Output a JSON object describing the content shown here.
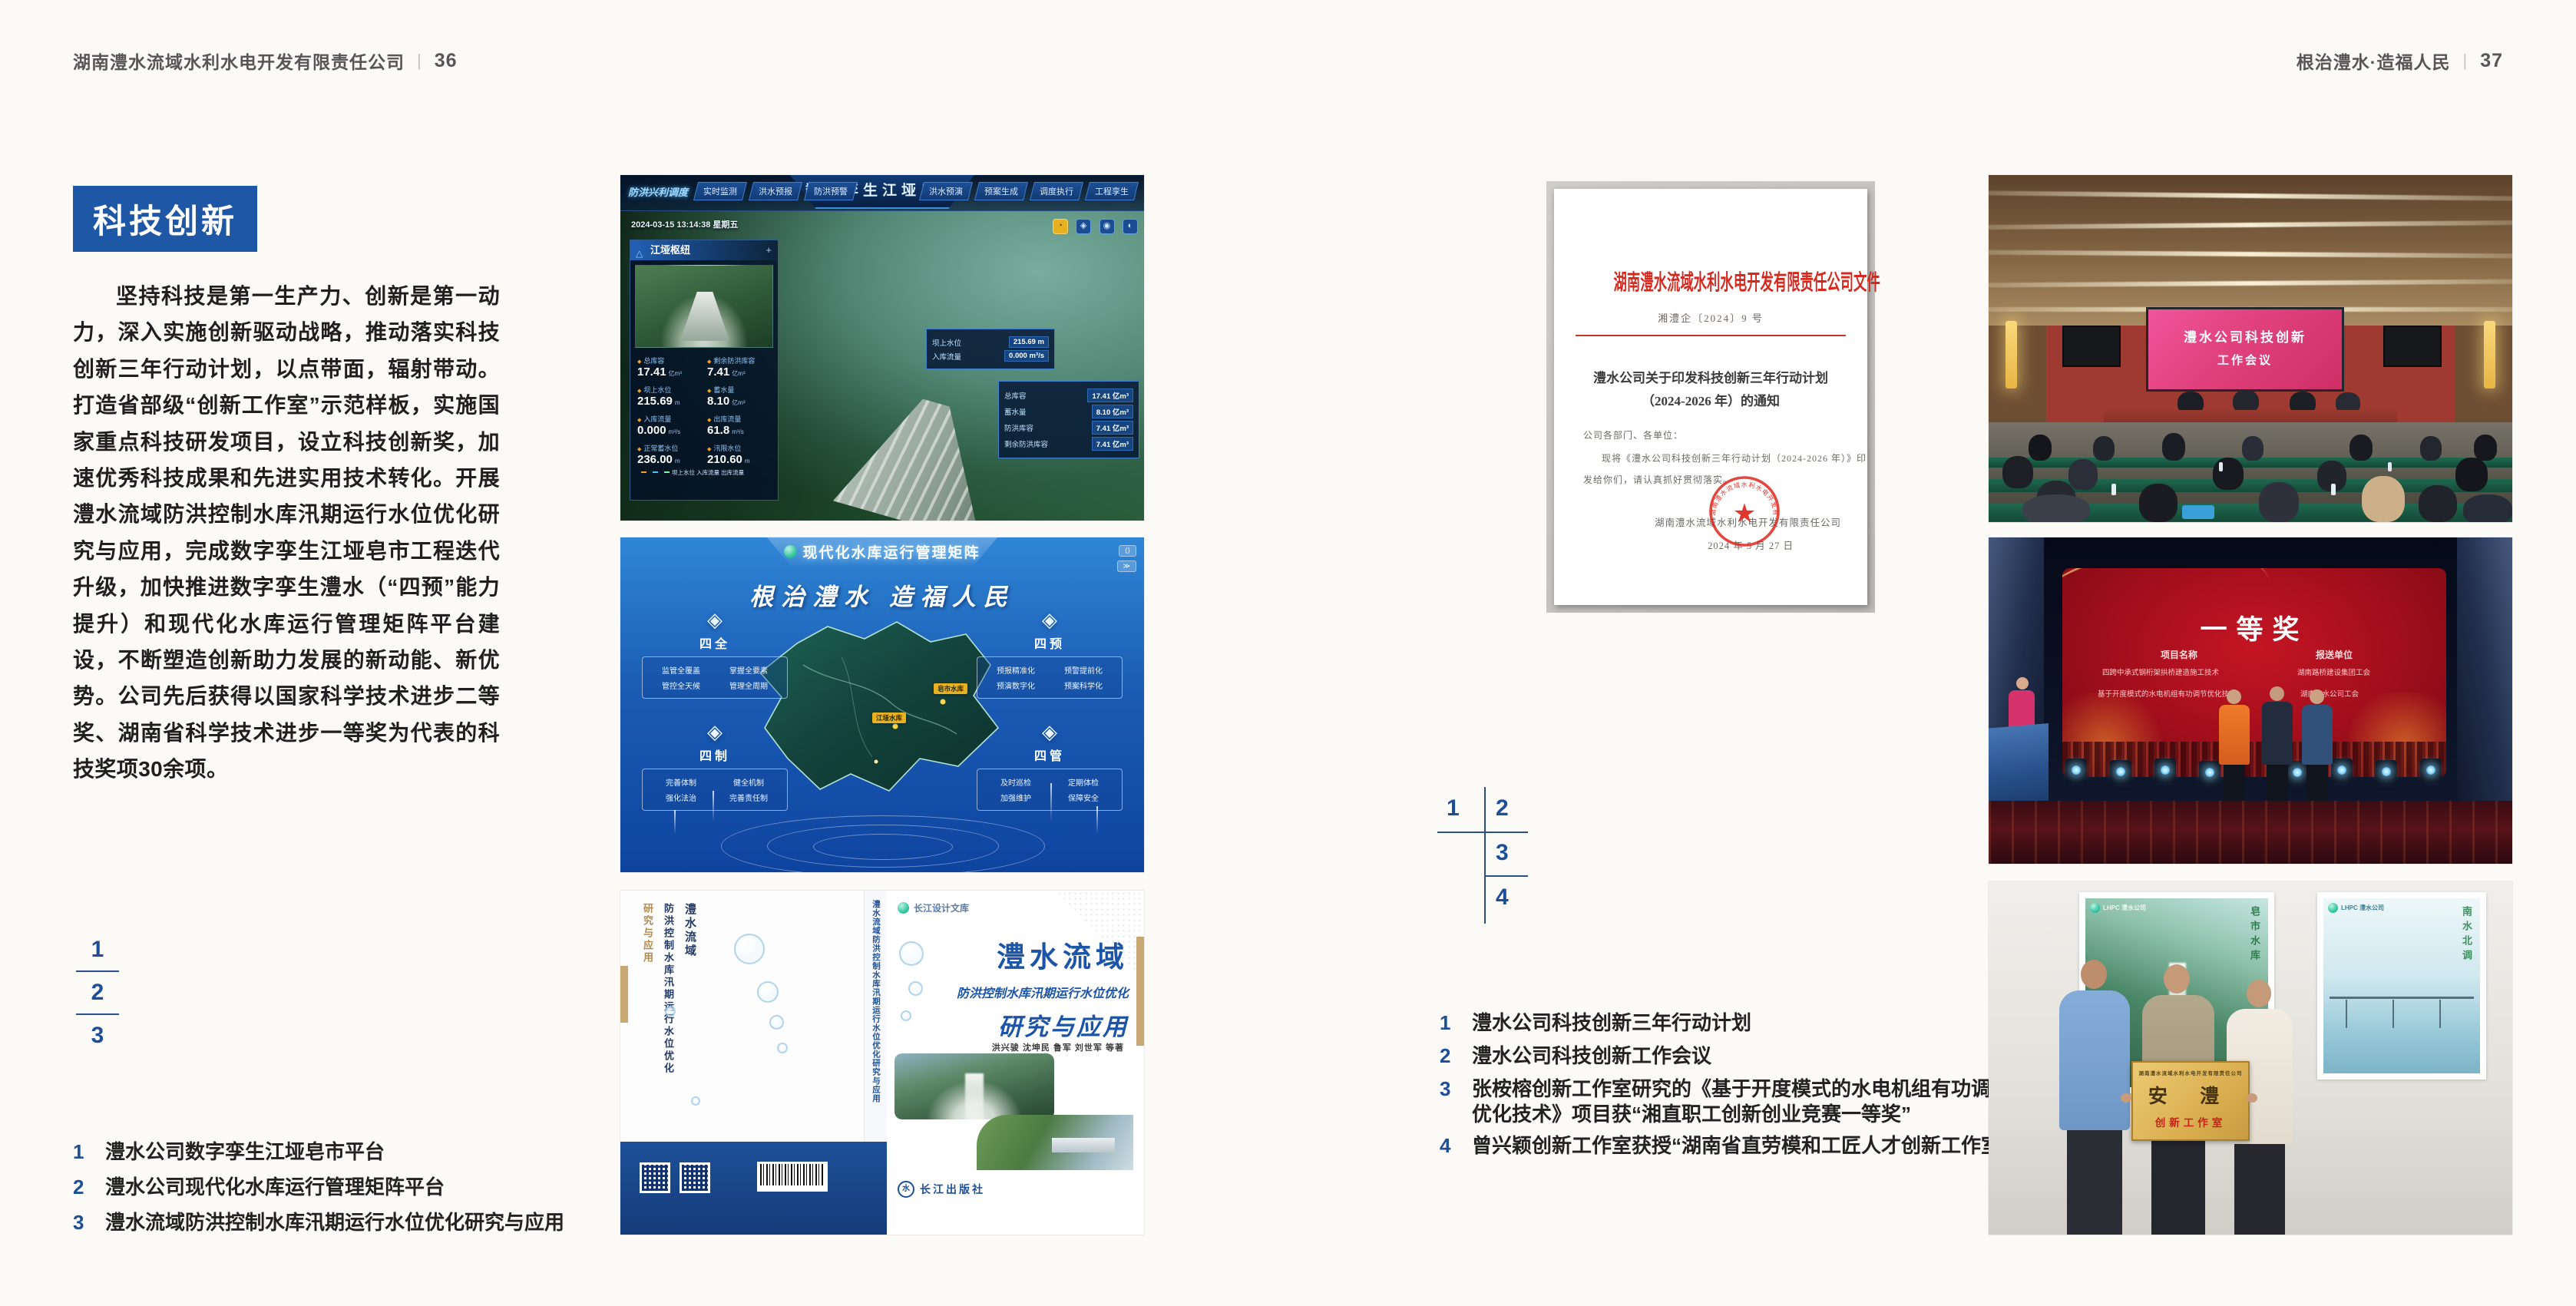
{
  "colors": {
    "accent_blue": "#1e57a5",
    "index_blue": "#1e4e96",
    "doc_red": "#d5281e"
  },
  "page_left": {
    "header": {
      "company": "湖南澧水流域水利水电开发有限责任公司",
      "divider": "|",
      "page_no": "36"
    },
    "section_title": "科技创新",
    "body_text": "坚持科技是第一生产力、创新是第一动力，深入实施创新驱动战略，推动落实科技创新三年行动计划，以点带面，辐射带动。打造省部级“创新工作室”示范样板，实施国家重点科技研发项目，设立科技创新奖，加速优秀科技成果和先进实用技术转化。开展澧水流域防洪控制水库汛期运行水位优化研究与应用，完成数字孪生江垭皂市工程迭代升级，加快推进数字孪生澧水（“四预”能力提升）和现代化水库运行管理矩阵平台建设，不断塑造创新助力发展的新动能、新优势。公司先后获得以国家科学技术进步二等奖、湖南省科学技术进步一等奖为代表的科技奖项30余项。",
    "figure_index": [
      "1",
      "2",
      "3"
    ],
    "captions": [
      {
        "no": "1",
        "text": "澧水公司数字孪生江垭皂市平台"
      },
      {
        "no": "2",
        "text": "澧水公司现代化水库运行管理矩阵平台"
      },
      {
        "no": "3",
        "text": "澧水流域防洪控制水库汛期运行水位优化研究与应用"
      }
    ]
  },
  "page_right": {
    "header": {
      "slogan": "根治澧水·造福人民",
      "divider": "|",
      "page_no": "37"
    },
    "figure_index": [
      "1",
      "2",
      "3",
      "4"
    ],
    "captions": [
      {
        "no": "1",
        "line1": "澧水公司科技创新三年行动计划"
      },
      {
        "no": "2",
        "line1": "澧水公司科技创新工作会议"
      },
      {
        "no": "3",
        "line1": "张桉榕创新工作室研究的《基于开度模式的水电机组有功调节",
        "line2": "优化技术》项目获“湘直职工创新创业竞赛一等奖”"
      },
      {
        "no": "4",
        "line1": "曾兴颖创新工作室获授“湖南省直劳模和工匠人才创新工作室”"
      }
    ]
  },
  "fig_twin": {
    "title": "数字孪生江垭皂市",
    "nav_group": "防洪兴利调度",
    "tabs_left": [
      "实时监测",
      "洪水预报",
      "防洪预警"
    ],
    "tabs_right": [
      "洪水预演",
      "预案生成",
      "调度执行",
      "工程孪生"
    ],
    "timestamp": "2024-03-15 13:14:38 星期五",
    "panel_title": "江垭枢纽",
    "stats": [
      {
        "label": "总库容",
        "value": "17.41",
        "unit": "亿m³"
      },
      {
        "label": "剩余防洪库容",
        "value": "7.41",
        "unit": "亿m³"
      },
      {
        "label": "坝上水位",
        "value": "215.69",
        "unit": "m"
      },
      {
        "label": "蓄水量",
        "value": "8.10",
        "unit": "亿m³"
      },
      {
        "label": "入库流量",
        "value": "0.000",
        "unit": "m³/s"
      },
      {
        "label": "出库流量",
        "value": "61.8",
        "unit": "m³/s"
      },
      {
        "label": "正常蓄水位",
        "value": "236.00",
        "unit": "m"
      },
      {
        "label": "汛限水位",
        "value": "210.60",
        "unit": "m"
      }
    ],
    "legend": "坝上水位 入库流量 出库流量",
    "tip1": [
      {
        "label": "坝上水位",
        "value": "215.69 m"
      },
      {
        "label": "入库流量",
        "value": "0.000 m³/s"
      }
    ],
    "tip2": [
      {
        "label": "总库容",
        "value": "17.41 亿m³"
      },
      {
        "label": "蓄水量",
        "value": "8.10 亿m³"
      },
      {
        "label": "防洪库容",
        "value": "7.41 亿m³"
      },
      {
        "label": "剩余防洪库容",
        "value": "7.41 亿m³"
      }
    ]
  },
  "fig_matrix": {
    "title": "现代化水库运行管理矩阵",
    "slogan": "根治澧水 造福人民",
    "quadrants": [
      {
        "name": "四全",
        "items": [
          "监管全覆盖",
          "掌握全要素",
          "管控全天候",
          "管理全周期"
        ]
      },
      {
        "name": "四预",
        "items": [
          "预报精准化",
          "预警提前化",
          "预演数字化",
          "预案科学化"
        ]
      },
      {
        "name": "四制",
        "items": [
          "完善体制",
          "健全机制",
          "强化法治",
          "完善责任制"
        ]
      },
      {
        "name": "四管",
        "items": [
          "及时巡检",
          "定期体检",
          "加强维护",
          "保障安全"
        ]
      }
    ],
    "markers": [
      "皂市水库",
      "江垭水库"
    ]
  },
  "fig_book": {
    "series": "长江设计文库",
    "title_main": "澧水流域",
    "title_sub": "防洪控制水库汛期运行水位优化",
    "title_tail": "研究与应用",
    "authors": "洪兴骏 沈坤民 鲁军 刘世军 等著",
    "publisher": "长江出版社",
    "publisher_mark": "水",
    "spine_text": "澧水流域防洪控制水库汛期运行水位优化研究与应用",
    "back_line1": "澧水流域",
    "back_line2": "防洪控制水库汛期运行水位优化",
    "back_line3": "研究与应用"
  },
  "document": {
    "header": "湖南澧水流域水利水电开发有限责任公司文件",
    "doc_no": "湘澧企〔2024〕9 号",
    "title_line1": "澧水公司关于印发科技创新三年行动计划",
    "title_line2": "（2024-2026 年）的通知",
    "salutation": "公司各部门、各单位：",
    "body_line1": "现将《澧水公司科技创新三年行动计划（2024-2026 年）》印",
    "body_line2": "发给你们，请认真抓好贯彻落实。",
    "signer": "湖南澧水流域水利水电开发有限责任公司",
    "date": "2024 年 5 月 27 日",
    "seal_text": "湖南澧水流域水利水电开发有限责任公司",
    "seal_star": "★"
  },
  "photo_meeting": {
    "screen_line1": "澧水公司科技创新",
    "screen_line2": "工作会议"
  },
  "photo_award": {
    "title": "一等奖",
    "col1": "项目名称",
    "col2": "报送单位",
    "rows": [
      {
        "project": "四跨中承式钢桁架拱桥建造施工技术",
        "unit": "湖南路桥建设集团工会"
      },
      {
        "project": "基于开度模式的水电机组有功调节优化技术",
        "unit": "湖南澧水公司工会"
      }
    ]
  },
  "photo_plaque": {
    "poster_left_text": "皂市水库",
    "poster_right_text": "南水北调",
    "poster_logo": "LHPC 澧水公司",
    "plaque_header": "湖南澧水流域水利水电开发有限责任公司",
    "plaque_main": "安 澧",
    "plaque_sub": "创新工作室"
  }
}
